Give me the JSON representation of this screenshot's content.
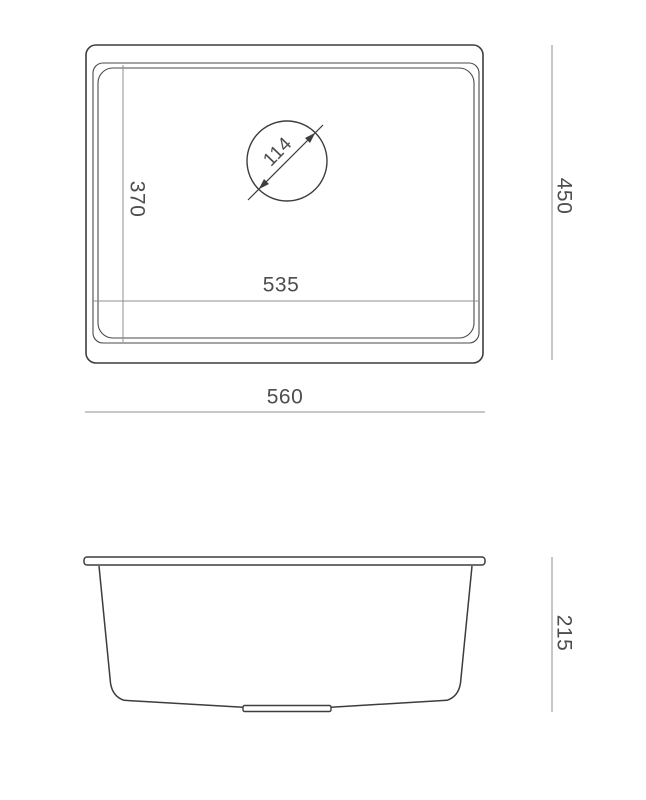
{
  "drawing": {
    "description": "Kitchen sink technical dimension drawing, top view and side view",
    "colors": {
      "background": "#ffffff",
      "outline": "#3d3d3d",
      "dimension_line": "#8f8f8f",
      "dimension_text": "#4d4d4d"
    },
    "top_view": {
      "outer_width_mm": "560",
      "outer_depth_mm": "450",
      "bowl_width_mm": "535",
      "bowl_depth_mm": "370",
      "drain_diameter_mm": "114"
    },
    "side_view": {
      "height_mm": "215"
    }
  }
}
